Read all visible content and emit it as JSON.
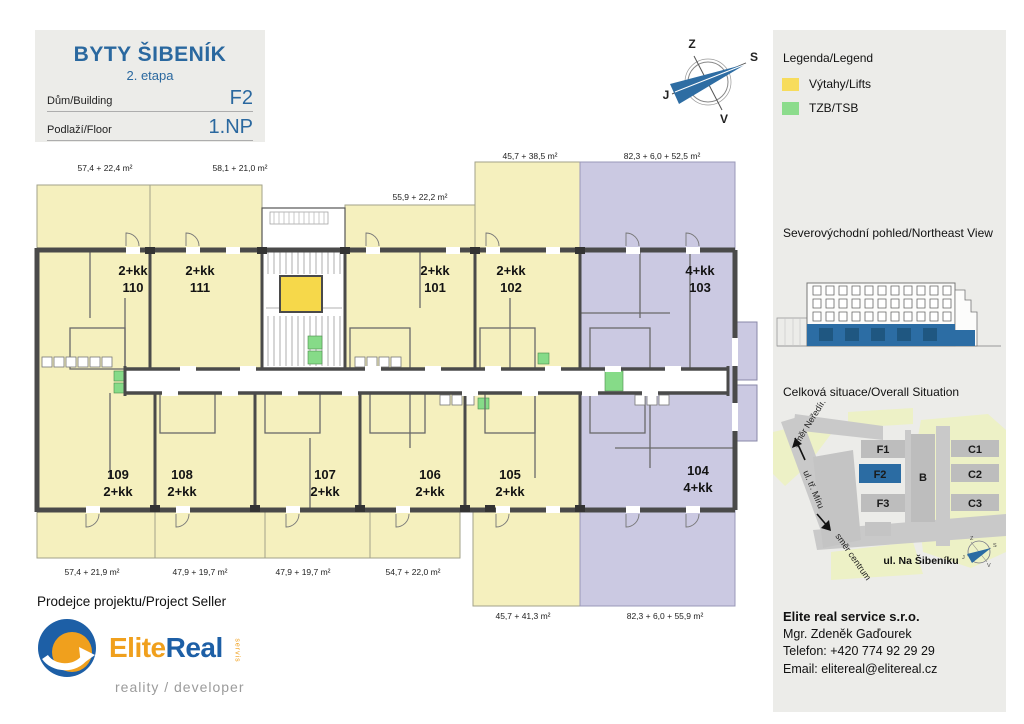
{
  "header": {
    "title": "BYTY ŠIBENÍK",
    "subtitle": "2. etapa",
    "building_label": "Dům/Building",
    "building_value": "F2",
    "floor_label": "Podlaží/Floor",
    "floor_value": "1.NP"
  },
  "compass": {
    "top": "Z",
    "right": "S",
    "left": "J",
    "bottom": "V"
  },
  "plan": {
    "top_units": [
      {
        "type": "2+kk",
        "number": "110",
        "area": "57,4 + 22,4 m²"
      },
      {
        "type": "2+kk",
        "number": "111",
        "area": "58,1 + 21,0 m²"
      },
      {
        "type": "2+kk",
        "number": "101",
        "area": "55,9 + 22,2 m²"
      },
      {
        "type": "2+kk",
        "number": "102",
        "area": "45,7 + 38,5 m²"
      },
      {
        "type": "4+kk",
        "number": "103",
        "area": "82,3 + 6,0 + 52,5 m²"
      }
    ],
    "bottom_units": [
      {
        "number": "109",
        "type": "2+kk",
        "area": "57,4 + 21,9 m²"
      },
      {
        "number": "108",
        "type": "2+kk",
        "area": "47,9 + 19,7 m²"
      },
      {
        "number": "107",
        "type": "2+kk",
        "area": "47,9 + 19,7 m²"
      },
      {
        "number": "106",
        "type": "2+kk",
        "area": "54,7 + 22,0 m²"
      },
      {
        "number": "105",
        "type": "2+kk",
        "area": "45,7 + 41,3 m²"
      },
      {
        "number": "104",
        "type": "4+kk",
        "area": "82,3 + 6,0 + 55,9 m²"
      }
    ]
  },
  "legend": {
    "title": "Legenda/Legend",
    "items": [
      {
        "label": "Výtahy/Lifts",
        "color": "#F7DC5C"
      },
      {
        "label": "TZB/TSB",
        "color": "#8CDC8C"
      }
    ]
  },
  "elevation": {
    "title": "Severovýchodní pohled/Northeast View"
  },
  "situation": {
    "title": "Celková situace/Overall Situation",
    "buildings": {
      "f1": "F1",
      "f2": "F2",
      "f3": "F3",
      "b": "B",
      "c1": "C1",
      "c2": "C2",
      "c3": "C3"
    },
    "street_main": "ul. Na Šibeníku",
    "street_diag": "ul. tř. Míru",
    "dir_nw": "směr Neředín",
    "dir_s": "směr centrum"
  },
  "seller": {
    "heading": "Prodejce projektu/Project Seller",
    "company": "Elite real service s.r.o.",
    "person": "Mgr. Zdeněk Gaďourek",
    "phone": "Telefon: +420 774 92 29 29",
    "email": "Email: elitereal@elitereal.cz"
  },
  "logo": {
    "part1": "Elite",
    "part2": "Real",
    "vertical": "servis",
    "tagline": "reality / developer"
  },
  "colors": {
    "accent_blue": "#2B6CA3",
    "lift_yellow": "#F6D84A",
    "tzb_green": "#86DB88",
    "unit_yellow": "#F5F0BE",
    "unit_lavender": "#CBC9E2",
    "wall_gray": "#4A4A4A"
  }
}
